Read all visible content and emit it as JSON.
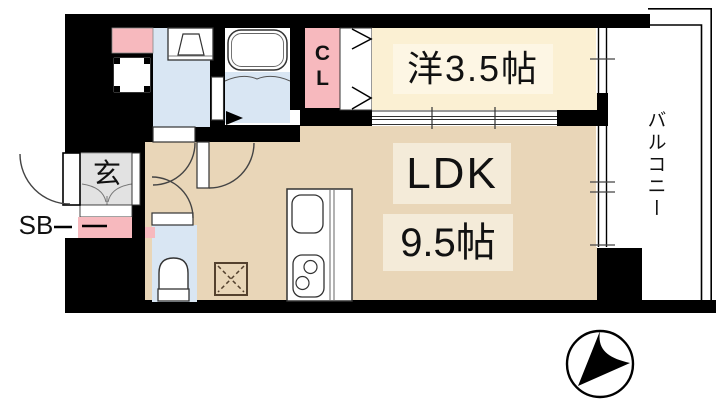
{
  "document": {
    "type": "apartment-floor-plan"
  },
  "rooms": {
    "western_room": {
      "label": "洋3.5帖"
    },
    "ldk": {
      "label": "LDK",
      "size_label": "9.5帖"
    },
    "balcony": {
      "label": "バルコニー"
    },
    "closet": {
      "label": "CL"
    },
    "entrance": {
      "label": "玄"
    },
    "shoe_box": {
      "label": "SB"
    }
  },
  "fixtures": [
    "bathtub",
    "vanity-sink",
    "washing-machine-pan",
    "toilet",
    "kitchen-sink",
    "stove-two-burner",
    "refrigerator-space-x-box",
    "sliding-window",
    "folding-closet-doors",
    "north-compass"
  ],
  "colors": {
    "wall": "#000000",
    "wet_area_blue": "#d9e6f3",
    "western_room_cream": "#fbf0d3",
    "ldk_tan": "#e9d6b8",
    "accent_pink": "#f7b9be",
    "entrance_gray": "#e2e2e2"
  }
}
